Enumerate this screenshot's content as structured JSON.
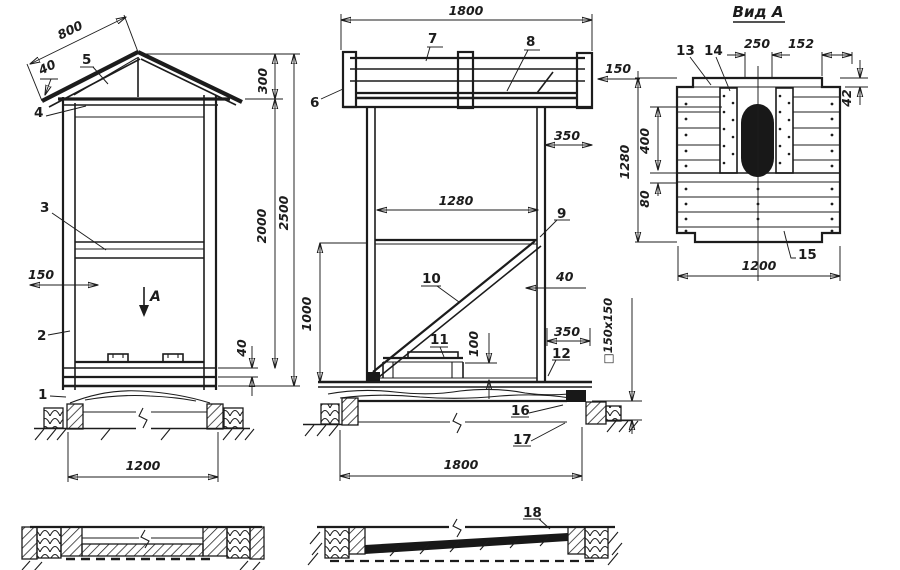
{
  "colors": {
    "ink": "#1c1c1c",
    "paper": "#ffffff",
    "hole_fill": "#181818"
  },
  "front": {
    "d800": "800",
    "d40_roof": "40",
    "l5": "5",
    "l4": "4",
    "d300": "300",
    "d2000": "2000",
    "d2500": "2500",
    "l3": "3",
    "d150": "150",
    "a_letter": "A",
    "l2": "2",
    "l1": "1",
    "d40_floor": "40",
    "d1200": "1200"
  },
  "side": {
    "d1800_top": "1800",
    "l6": "6",
    "l7": "7",
    "l8": "8",
    "d150": "150",
    "d350_top": "350",
    "d1280": "1280",
    "l9": "9",
    "l10": "10",
    "d40": "40",
    "d1000": "1000",
    "l11": "11",
    "d100": "100",
    "d350_bot": "350",
    "l12": "12",
    "d_section": "□150x150",
    "l16": "16",
    "l17": "17",
    "d1800_bot": "1800",
    "l18": "18"
  },
  "rear": {
    "title": "Вид А",
    "l13": "13",
    "l14": "14",
    "d250": "250",
    "d152": "152",
    "d42": "42",
    "d1280": "1280",
    "d400": "400",
    "d80": "80",
    "l15": "15",
    "d1200": "1200"
  }
}
